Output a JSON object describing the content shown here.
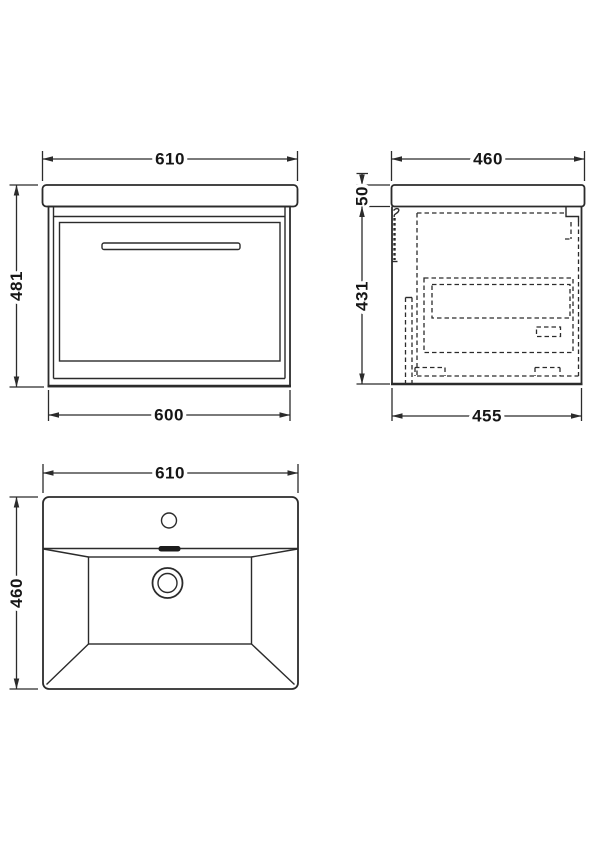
{
  "colors": {
    "line": "#2b2b2b",
    "background": "#ffffff",
    "overflow_fill": "#1c1c1c"
  },
  "front_view": {
    "dim_top_width": "610",
    "dim_height": "481",
    "dim_bottom_width": "600"
  },
  "side_view": {
    "dim_top_depth": "460",
    "dim_counter_thickness": "50",
    "dim_cabinet_height": "431",
    "dim_bottom_depth": "455"
  },
  "plan_view": {
    "dim_width": "610",
    "dim_depth": "460"
  }
}
